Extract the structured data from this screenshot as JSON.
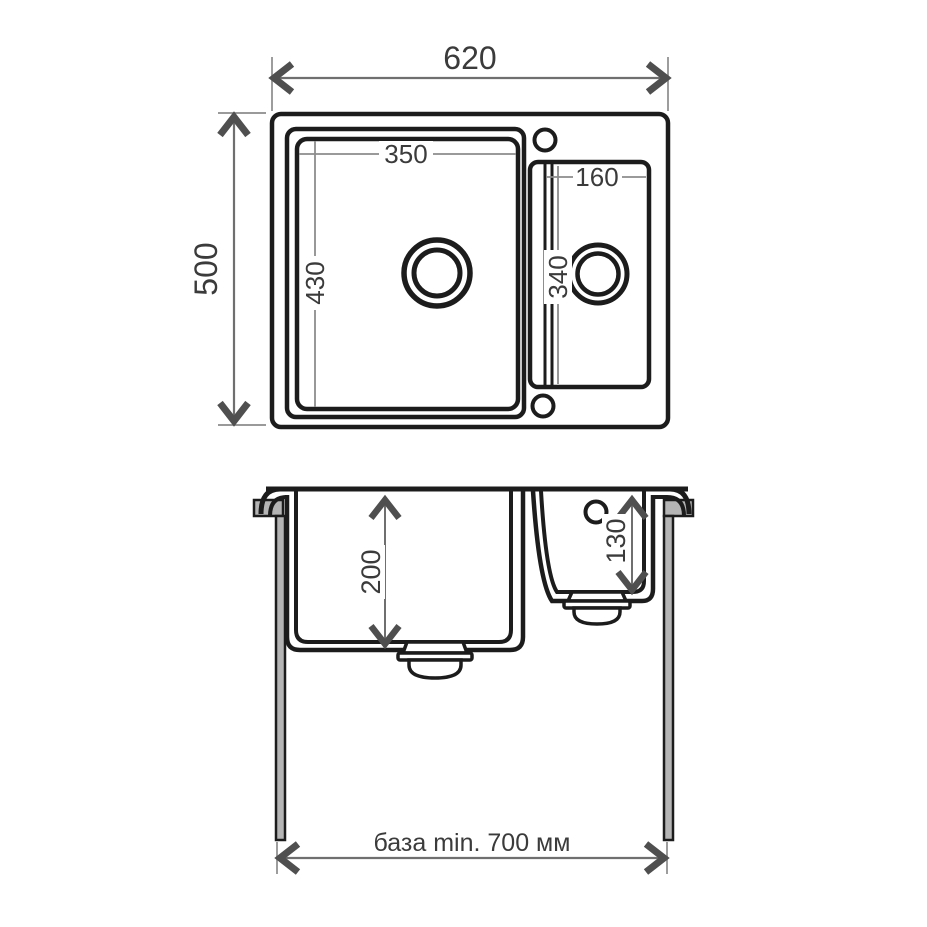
{
  "drawing": {
    "type": "technical-drawing",
    "subject": "double-bowl-kitchen-sink",
    "units": "mm",
    "top_view": {
      "overall_width": "620",
      "overall_depth": "500",
      "main_bowl_width": "350",
      "main_bowl_length": "430",
      "second_bowl_width": "160",
      "second_bowl_length": "340"
    },
    "front_view": {
      "main_bowl_depth": "200",
      "second_bowl_depth": "130",
      "base_cabinet": "база min. 700 мм"
    },
    "colors": {
      "line": "#1c1c1c",
      "dimension_line": "#6f6f6f",
      "extension_line": "#8c8c8c",
      "arrow": "#4f4f4f",
      "gray_fill": "#b5b5b5",
      "background": "#ffffff"
    }
  }
}
